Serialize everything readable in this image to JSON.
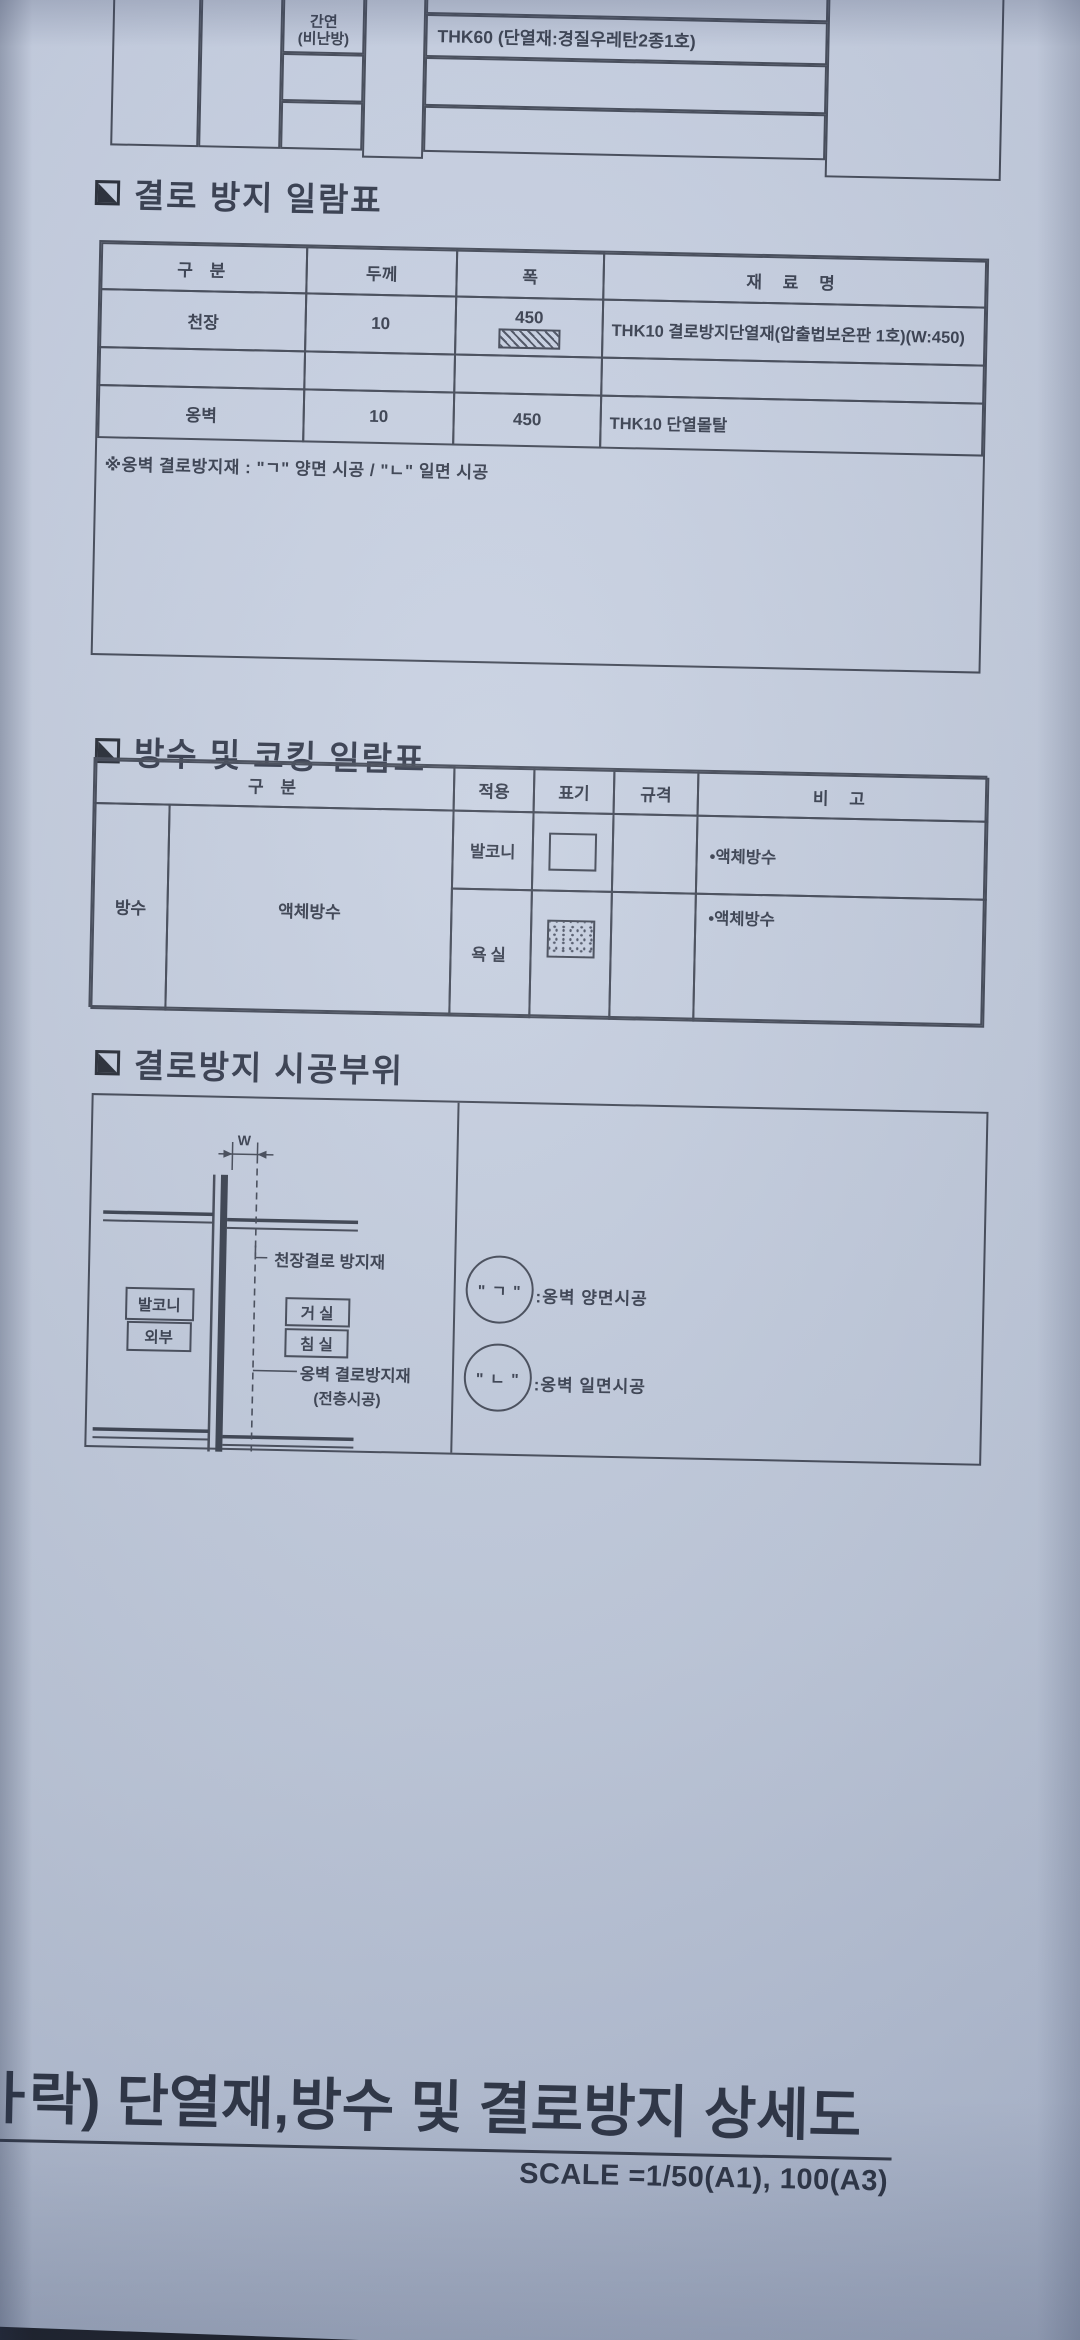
{
  "colors": {
    "paper": "#c5cedf",
    "line": "#3e4452",
    "ink": "#323949",
    "title_ink": "#272e3e"
  },
  "top_table": {
    "row_label_line1": "간연",
    "row_label_line2": "(비난방)",
    "material": "THK60 (단열재:경질우레탄2종1호)"
  },
  "condensation_table": {
    "section_title": "결로 방지 일람표",
    "headers": {
      "category": "구  분",
      "thickness": "두께",
      "width": "폭",
      "material": "재 료 명"
    },
    "rows": [
      {
        "category": "천장",
        "thickness": "10",
        "width": "450",
        "width_symbol": "diagonal-hatch-swatch",
        "material": "THK10 결로방지단열재(압출법보온판 1호)(W:450)"
      },
      {
        "category": "",
        "thickness": "",
        "width": "",
        "material": ""
      },
      {
        "category": "옹벽",
        "thickness": "10",
        "width": "450",
        "material": "THK10 단열몰탈"
      }
    ],
    "note": "※옹벽 결로방지재 : \"ㄱ\" 양면 시공 / \"ㄴ\" 일면 시공"
  },
  "waterproof_table": {
    "section_title": "방수 및 코킹 일람표",
    "headers": {
      "category": "구  분",
      "application": "적용",
      "mark": "표기",
      "spec": "규격",
      "remark": "비  고"
    },
    "group": "방수",
    "subgroup": "액체방수",
    "rows": [
      {
        "application": "발코니",
        "mark_symbol": "empty-box",
        "spec": "",
        "remark": "•액체방수"
      },
      {
        "application": "욕실",
        "mark_symbol": "stippled-box",
        "spec": "",
        "remark": "•액체방수"
      }
    ]
  },
  "diagram": {
    "section_title": "결로방지 시공부위",
    "dimension_label": "W",
    "labels": {
      "ceiling": "천장결로 방지재",
      "balcony": "발코니",
      "exterior": "외부",
      "living": "거 실",
      "bedroom": "침 실",
      "wall_line1": "옹벽 결로방지재",
      "wall_line2": "(전층시공)"
    },
    "legend": [
      {
        "symbol": "\" ㄱ \"",
        "text": ":옹벽 양면시공"
      },
      {
        "symbol": "\" ㄴ \"",
        "text": ":옹벽 일면시공"
      }
    ]
  },
  "footer": {
    "clipped_char": "ㅏ",
    "title": "락) 단열재,방수 및 결로방지 상세도",
    "scale": "SCALE =1/50(A1), 100(A3)"
  }
}
